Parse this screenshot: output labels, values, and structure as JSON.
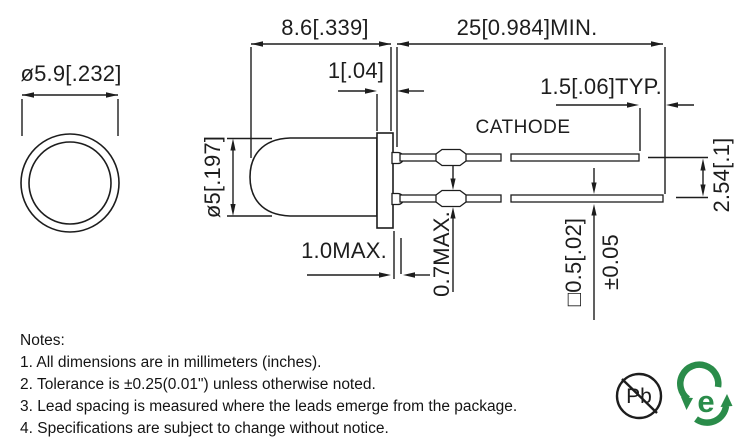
{
  "top_view": {
    "flange_diameter": "ø5.9[.232]"
  },
  "side_view": {
    "body_length": "8.6[.339]",
    "flange_thickness": "1[.04]",
    "lead_length_min": "25[0.984]MIN.",
    "lead_tip_typ": "1.5[.06]TYP.",
    "cathode_label": "CATHODE",
    "body_diameter": "ø5[.197]",
    "lead_pitch": "2.54[.1]",
    "standoff_max": "1.0MAX.",
    "crimp_max": "0.7MAX.",
    "lead_square": "□0.5[.02]",
    "lead_tolerance": "±0.05"
  },
  "notes": {
    "title": "Notes:",
    "items": [
      "1. All dimensions are in millimeters (inches).",
      "2. Tolerance is ±0.25(0.01\") unless otherwise noted.",
      "3. Lead spacing is measured where the leads emerge from the package.",
      "4. Specifications are subject to change without notice."
    ]
  },
  "icons": {
    "pb_free": "Pb",
    "rohs_e": "e",
    "green_color": "#2a8c4a",
    "line_color": "#1d1d1d"
  }
}
